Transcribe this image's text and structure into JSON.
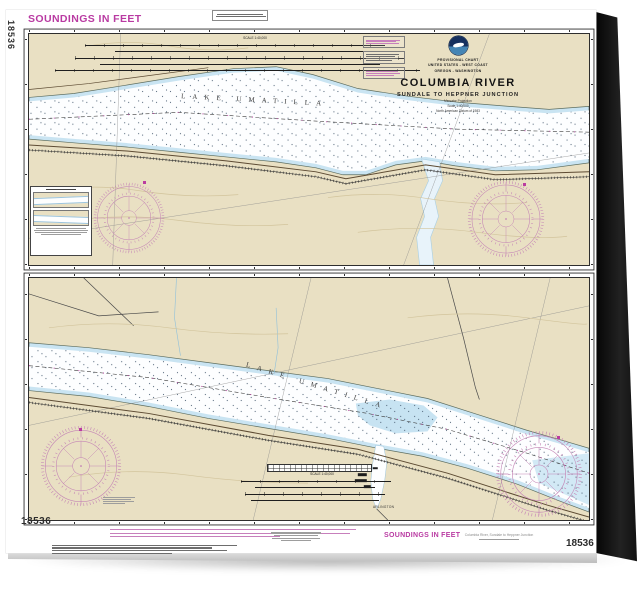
{
  "colors": {
    "land": "#e9e0c3",
    "water": "#fdfeff",
    "shallow_water": "#c9e4f2",
    "noaa_magenta": "#b93aa2",
    "compass_rose": "#c484b5",
    "ink": "#2e2e2e",
    "caption_gray": "#8a8a8a"
  },
  "sheet": {
    "soundings_note_top": "SOUNDINGS IN FEET",
    "soundings_note_bottom": "SOUNDINGS IN FEET",
    "chart_number_side": "18536",
    "chart_number_bottom_left": "18536",
    "chart_number_bottom_right": "18536",
    "product_caption": "Columbia River, Sundale to Heppner Junction"
  },
  "title_block": {
    "type_line": "PROVISIONAL CHART",
    "region_line": "UNITED STATES - WEST COAST",
    "state_line": "OREGON - WASHINGTON",
    "title": "COLUMBIA RIVER",
    "subtitle": "SUNDALE TO HEPPNER JUNCTION",
    "projection_lines": [
      "Mercator Projection",
      "Scale 1:40,000",
      "North American Datum of 1983"
    ]
  },
  "top_panel": {
    "water_label": "LAKE UMATILLA",
    "scale_label": "SCALE 1:40,000"
  },
  "bottom_panel": {
    "water_label": "LAKE UMATILLA",
    "scale_label": "SCALE 1:40,000",
    "town_label": "ARLINGTON"
  }
}
